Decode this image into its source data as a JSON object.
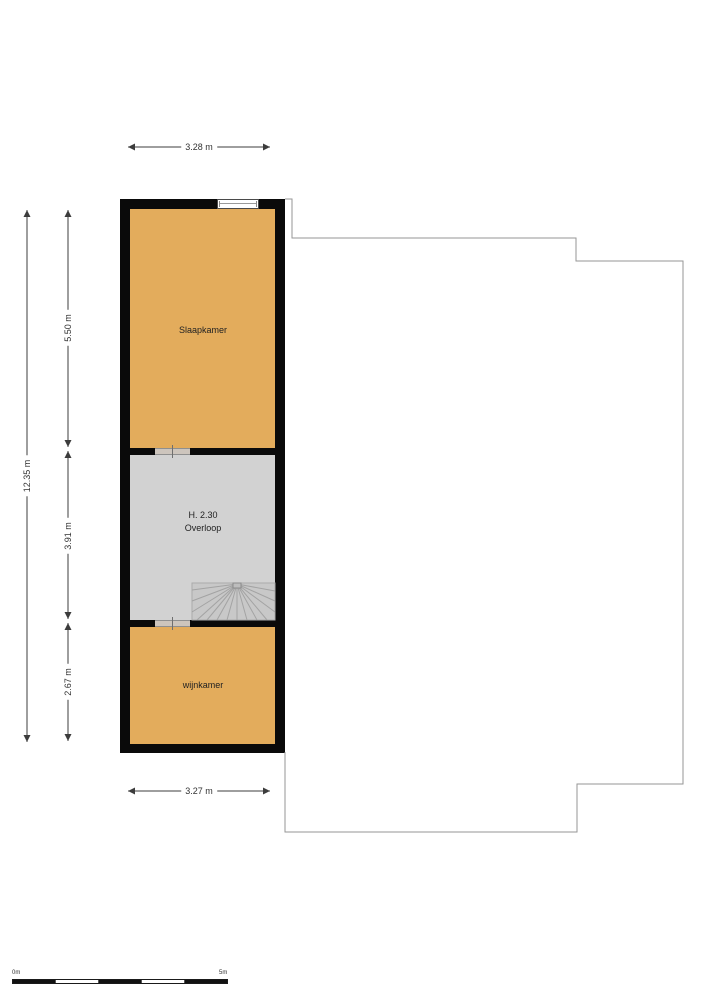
{
  "floorplan": {
    "rooms": [
      {
        "id": "slaapkamer",
        "label": "Slaapkamer"
      },
      {
        "id": "overloop",
        "label": "Overloop",
        "height_label": "H. 2.30"
      },
      {
        "id": "wijnkamer",
        "label": "wijnkamer"
      }
    ],
    "dimensions": {
      "top_width": "3.28 m",
      "bottom_width": "3.27 m",
      "total_height": "12.35 m",
      "segment_heights": [
        "5.50 m",
        "3.91 m",
        "2.67 m"
      ]
    },
    "scale_bar": {
      "start_label": "0m",
      "end_label": "5m"
    },
    "colors": {
      "room_fill": "#e3ac5c",
      "landing_fill": "#d2d2d2",
      "stairs_fill": "#c8c8c8",
      "wall": "#0a0a0a",
      "lower_floor_outline": "#969696"
    }
  }
}
